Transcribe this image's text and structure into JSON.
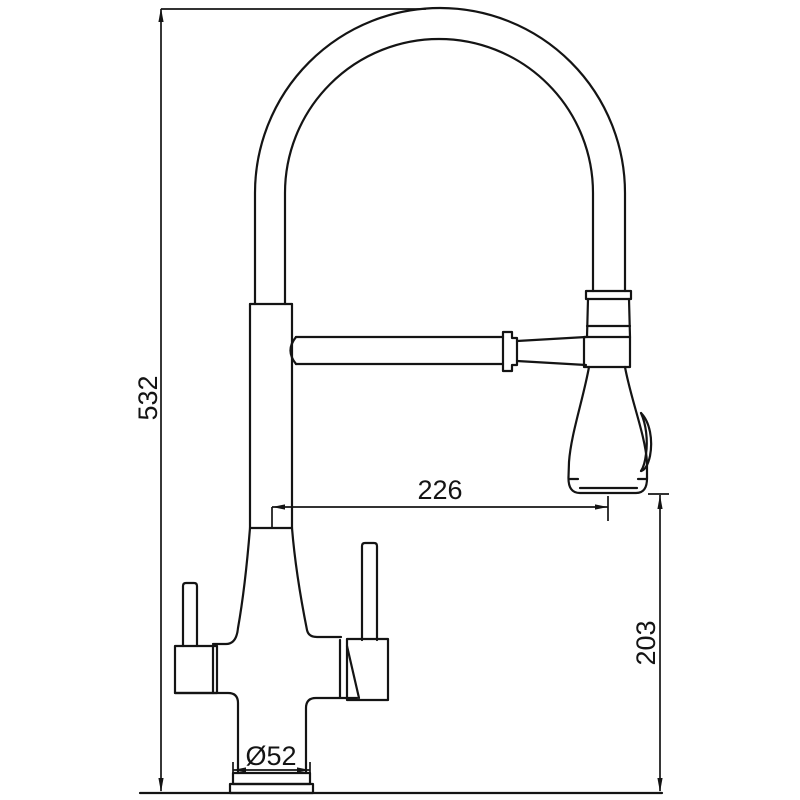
{
  "diagram": {
    "dimensions": {
      "overall_height": {
        "label": "532"
      },
      "spout_reach": {
        "label": "226"
      },
      "spray_head_height": {
        "label": "203"
      },
      "base_diameter": {
        "label": "Ø52"
      }
    },
    "colors": {
      "line": "#141414",
      "background": "#ffffff"
    }
  }
}
